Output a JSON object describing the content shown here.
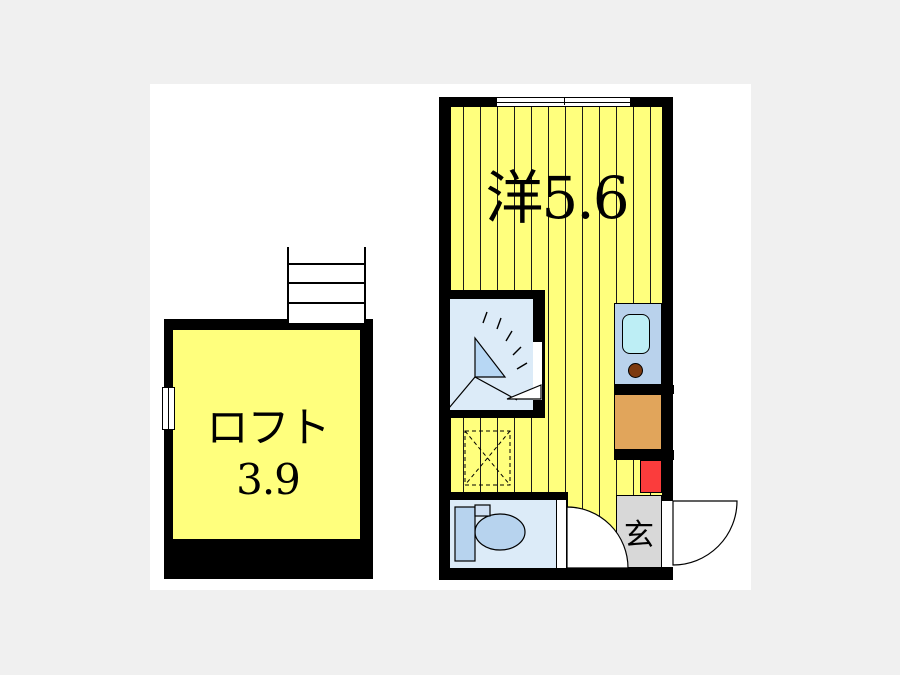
{
  "page": {
    "type": "apartment-floorplan-image",
    "background": "#f0f0f0",
    "canvas_background": "#ffffff"
  },
  "labels": {
    "western_room": "洋5.6",
    "loft": "ロフト3.9",
    "entrance": "玄"
  },
  "rooms": [
    {
      "name": "western-room",
      "label": "洋5.6",
      "size_tatami": "5.6",
      "fill": "#ffff7d",
      "floor": "striped"
    },
    {
      "name": "loft",
      "label": "ロフト3.9",
      "size_tatami": "3.9",
      "fill": "#ffff7d",
      "floor": "plain"
    },
    {
      "name": "entrance-genkan",
      "label": "玄",
      "fill": "#d8d8d8"
    },
    {
      "name": "shower-room",
      "fill": "#dcebf8"
    },
    {
      "name": "toilet-room",
      "fill": "#dcebf8"
    }
  ],
  "fixtures": [
    "stairs",
    "loft-side-window",
    "sliding-window",
    "shower-unit",
    "kitchen-counter",
    "kitchen-sink",
    "gas-burner",
    "refrigerator-space",
    "water-heater",
    "washing-machine-space",
    "toilet",
    "interior-door-swing",
    "entrance-door-swing"
  ],
  "colors": {
    "page_bg": "#f0f0f0",
    "canvas_bg": "#ffffff",
    "wall": "#000000",
    "room_yellow": "#ffff7d",
    "stripe": "#1a1a1a",
    "wet_room_blue": "#dcebf8",
    "fixture_blue": "#b7d3ee",
    "shower_triangle": "#b7d7f4",
    "kitchen_counter": "#b9d2ec",
    "sink_cyan": "#bdeef5",
    "burner_brown": "#7c3a10",
    "appliance_orange": "#e1a55b",
    "heater_red": "#fb3c3c",
    "genkan_gray": "#d8d8d8"
  }
}
